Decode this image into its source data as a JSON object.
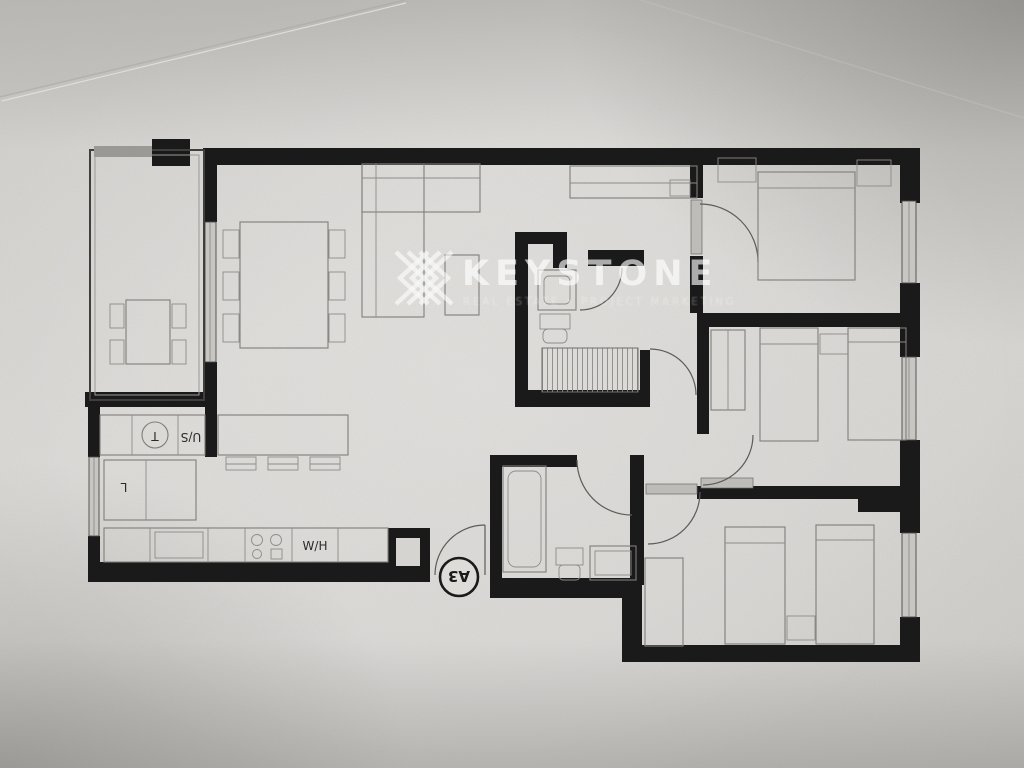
{
  "watermark": {
    "brand": "KEYSTONE",
    "subtitle": "REAL ESTATE • PROJECT MARKETING",
    "color": "#ffffff"
  },
  "plan": {
    "unit_label": "A3",
    "labels": {
      "water_heater": "W/H",
      "under_counter": "U/S",
      "closet": "L",
      "sink": "T"
    },
    "colors": {
      "wall": "#1a1a1a",
      "furniture_line": "#7f7e7a",
      "paper": "#d7d6d3"
    }
  }
}
